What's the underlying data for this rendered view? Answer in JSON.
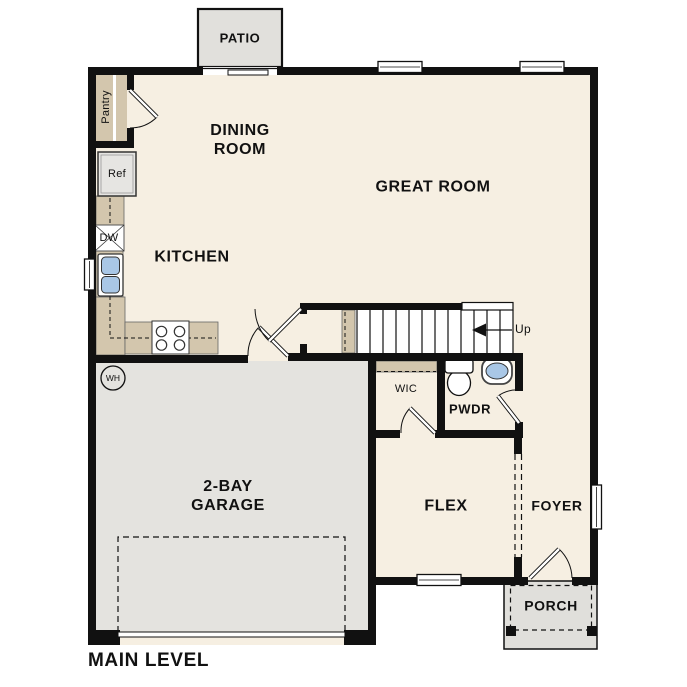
{
  "plan": {
    "title": "MAIN LEVEL",
    "rooms": {
      "patio": "PATIO",
      "dining_room": "DINING ROOM",
      "great_room": "GREAT ROOM",
      "kitchen": "KITCHEN",
      "garage": "2-BAY GARAGE",
      "wic": "WIC",
      "powder": "PWDR",
      "flex": "FLEX",
      "foyer": "FOYER",
      "porch": "PORCH"
    },
    "fixtures": {
      "pantry": "Pantry",
      "refrigerator": "Ref",
      "dishwasher": "DW",
      "water_heater": "WH",
      "stairs_direction": "Up"
    },
    "colors": {
      "floor": "#F6EFE2",
      "counter_tan": "#D3C6AD",
      "garage_gray": "#E4E3DF",
      "patio_gray": "#E1E0DC",
      "porch_gray": "#E0DFDB",
      "sink_blue": "#A9C7E6",
      "wall": "#111111"
    }
  }
}
